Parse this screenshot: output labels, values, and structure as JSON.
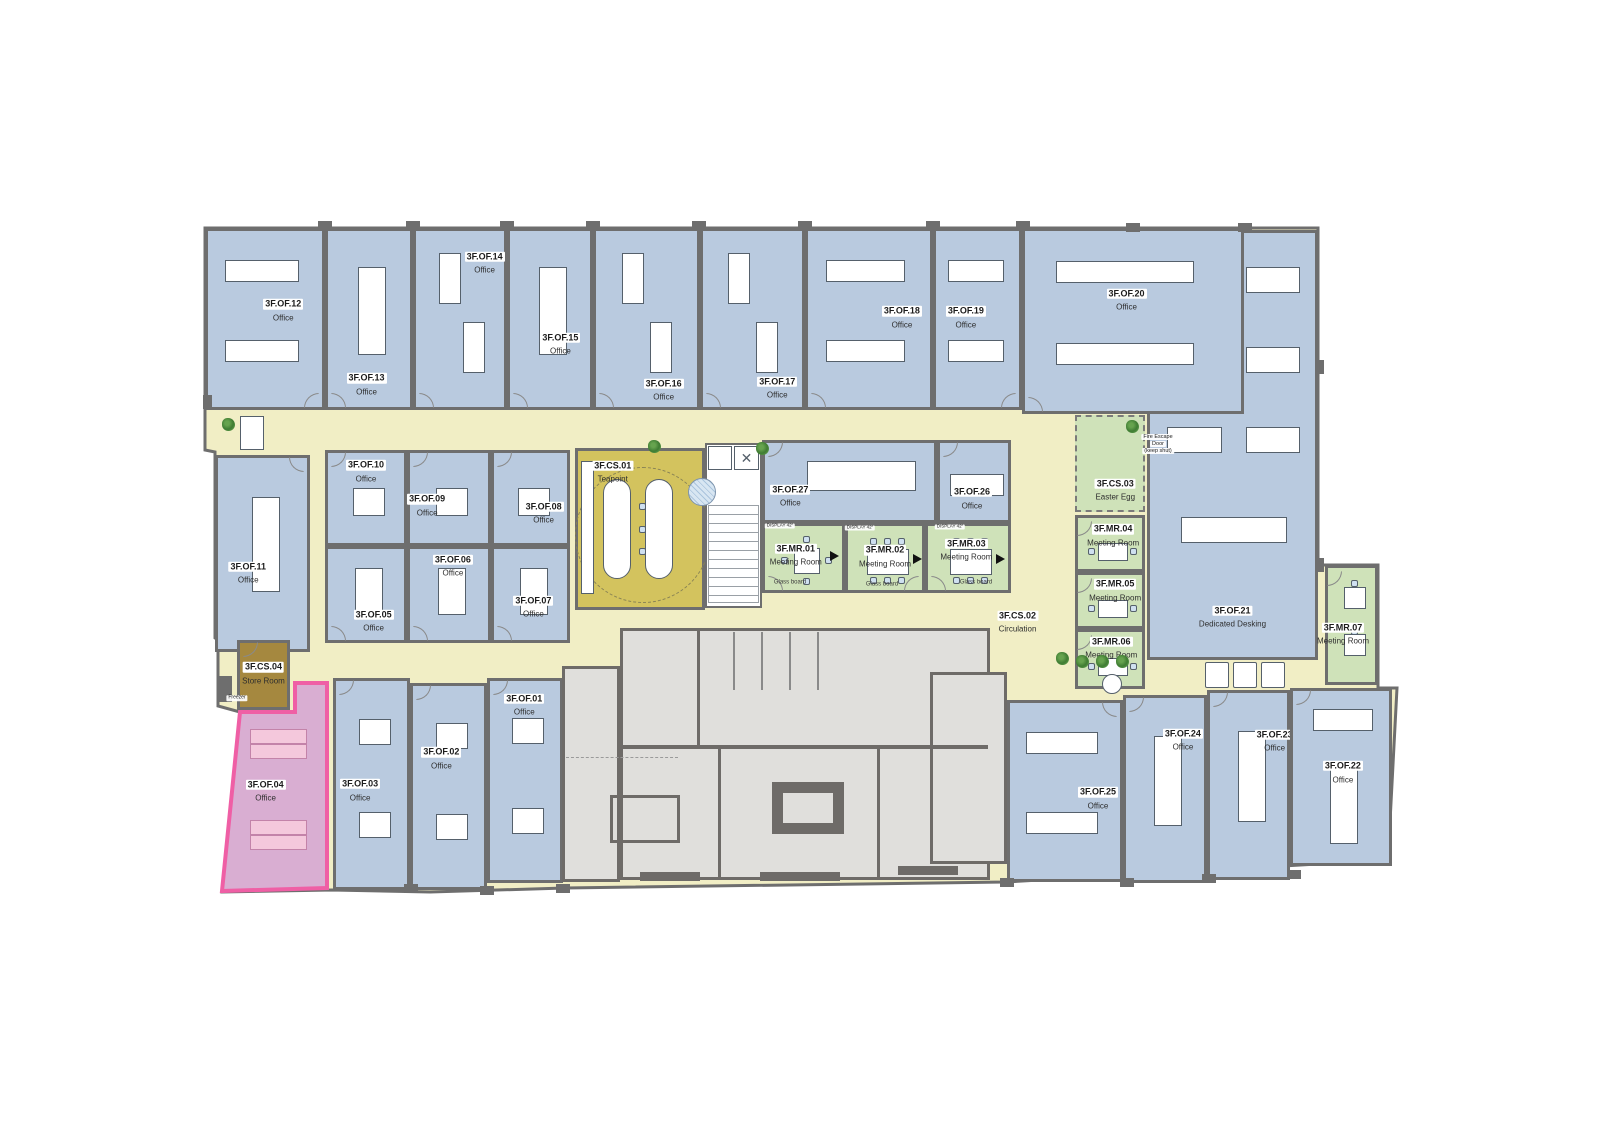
{
  "palette": {
    "office": "#b9cadf",
    "meeting": "#cfe2b9",
    "corridor": "#f1eec5",
    "teapoint": "#d3c35e",
    "store": "#a5883f",
    "special_office": "#d9aed2",
    "special_border": "#ef5fa5",
    "core": "#e0dfdc",
    "wall": "#6e6e6e"
  },
  "rooms": [
    {
      "code": "3F.OF.21",
      "name": "Dedicated Desking",
      "x": 1147,
      "y": 230,
      "w": 171,
      "h": 430,
      "t": "of",
      "lx": 0.5,
      "ly": 0.9,
      "f": "grid",
      "door": null
    },
    {
      "code": "3F.OF.12",
      "name": "Office",
      "x": 205,
      "y": 228,
      "w": 120,
      "h": 182,
      "t": "of",
      "lx": 0.66,
      "ly": 0.44,
      "f": "h2",
      "door": "br"
    },
    {
      "code": "3F.OF.13",
      "name": "Office",
      "x": 325,
      "y": 228,
      "w": 88,
      "h": 182,
      "t": "of",
      "lx": 0.47,
      "ly": 0.86,
      "f": "v1",
      "door": "bl"
    },
    {
      "code": "3F.OF.14",
      "name": "Office",
      "x": 413,
      "y": 228,
      "w": 94,
      "h": 182,
      "t": "of",
      "lx": 0.78,
      "ly": 0.17,
      "f": "v2sm",
      "door": "bl"
    },
    {
      "code": "3F.OF.15",
      "name": "Office",
      "x": 507,
      "y": 228,
      "w": 86,
      "h": 182,
      "t": "of",
      "lx": 0.63,
      "ly": 0.63,
      "f": "v1",
      "door": "bl"
    },
    {
      "code": "3F.OF.16",
      "name": "Office",
      "x": 593,
      "y": 228,
      "w": 107,
      "h": 182,
      "t": "of",
      "lx": 0.67,
      "ly": 0.89,
      "f": "v2sm",
      "door": "bl"
    },
    {
      "code": "3F.OF.17",
      "name": "Office",
      "x": 700,
      "y": 228,
      "w": 105,
      "h": 182,
      "t": "of",
      "lx": 0.75,
      "ly": 0.88,
      "f": "v2sm",
      "door": "bl"
    },
    {
      "code": "3F.OF.18",
      "name": "Office",
      "x": 805,
      "y": 228,
      "w": 128,
      "h": 182,
      "t": "of",
      "lx": 0.77,
      "ly": 0.48,
      "f": "h2",
      "door": "bl"
    },
    {
      "code": "3F.OF.19",
      "name": "Office",
      "x": 933,
      "y": 228,
      "w": 89,
      "h": 182,
      "t": "of",
      "lx": 0.36,
      "ly": 0.48,
      "f": "h2",
      "door": "br"
    },
    {
      "code": "3F.OF.20",
      "name": "Office",
      "x": 1022,
      "y": 228,
      "w": 222,
      "h": 186,
      "t": "of",
      "lx": 0.47,
      "ly": 0.37,
      "f": "h2",
      "door": "bl"
    },
    {
      "code": "3F.OF.11",
      "name": "Office",
      "x": 215,
      "y": 455,
      "w": 95,
      "h": 197,
      "t": "of",
      "lx": 0.34,
      "ly": 0.59,
      "f": "v1",
      "door": "tr"
    },
    {
      "code": "3F.OF.10",
      "name": "Office",
      "x": 325,
      "y": 450,
      "w": 82,
      "h": 96,
      "t": "of",
      "lx": 0.5,
      "ly": 0.18,
      "f": "sq1",
      "door": "tl"
    },
    {
      "code": "3F.OF.09",
      "name": "Office",
      "x": 407,
      "y": 450,
      "w": 84,
      "h": 96,
      "t": "of",
      "lx": 0.22,
      "ly": 0.56,
      "f": "sq1",
      "door": "tl"
    },
    {
      "code": "3F.OF.08",
      "name": "Office",
      "x": 491,
      "y": 450,
      "w": 79,
      "h": 96,
      "t": "of",
      "lx": 0.68,
      "ly": 0.64,
      "f": "sq1",
      "door": "tl"
    },
    {
      "code": "3F.OF.05",
      "name": "Office",
      "x": 325,
      "y": 546,
      "w": 82,
      "h": 97,
      "t": "of",
      "lx": 0.6,
      "ly": 0.77,
      "f": "v1",
      "door": "bl"
    },
    {
      "code": "3F.OF.06",
      "name": "Office",
      "x": 407,
      "y": 546,
      "w": 84,
      "h": 97,
      "t": "of",
      "lx": 0.55,
      "ly": 0.16,
      "f": "v1",
      "door": "bl"
    },
    {
      "code": "3F.OF.07",
      "name": "Office",
      "x": 491,
      "y": 546,
      "w": 79,
      "h": 97,
      "t": "of",
      "lx": 0.54,
      "ly": 0.61,
      "f": "v1",
      "door": "bl"
    },
    {
      "code": "3F.CS.01",
      "name": "Teapoint",
      "x": 575,
      "y": 448,
      "w": 130,
      "h": 162,
      "t": "tea",
      "lx": 0.28,
      "ly": 0.12,
      "f": "tea",
      "door": null
    },
    {
      "code": "3F.OF.27",
      "name": "Office",
      "x": 762,
      "y": 440,
      "w": 175,
      "h": 83,
      "t": "of",
      "lx": 0.15,
      "ly": 0.66,
      "f": "h1big",
      "door": "tl"
    },
    {
      "code": "3F.OF.26",
      "name": "Office",
      "x": 937,
      "y": 440,
      "w": 74,
      "h": 83,
      "t": "of",
      "lx": 0.47,
      "ly": 0.69,
      "f": "h1",
      "door": "tl"
    },
    {
      "code": "3F.MR.01",
      "name": "Meeting Room",
      "x": 762,
      "y": 523,
      "w": 83,
      "h": 70,
      "t": "mr",
      "lx": 0.4,
      "ly": 0.42,
      "f": "mtg4",
      "door": "bl"
    },
    {
      "code": "3F.MR.02",
      "name": "Meeting Room",
      "x": 845,
      "y": 523,
      "w": 80,
      "h": 70,
      "t": "mr",
      "lx": 0.5,
      "ly": 0.44,
      "f": "mtg6",
      "door": "br"
    },
    {
      "code": "3F.MR.03",
      "name": "Meeting Room",
      "x": 925,
      "y": 523,
      "w": 86,
      "h": 70,
      "t": "mr",
      "lx": 0.48,
      "ly": 0.34,
      "f": "mtg6",
      "door": "bl"
    },
    {
      "code": "3F.CS.03",
      "name": "Easter Egg",
      "x": 1075,
      "y": 415,
      "w": 70,
      "h": 97,
      "t": "egg",
      "lx": 0.58,
      "ly": 0.76,
      "f": null,
      "door": null
    },
    {
      "code": "3F.MR.04",
      "name": "Meeting Room",
      "x": 1075,
      "y": 515,
      "w": 70,
      "h": 57,
      "t": "mr",
      "lx": 0.55,
      "ly": 0.3,
      "f": "mtg2",
      "door": "lt"
    },
    {
      "code": "3F.MR.05",
      "name": "Meeting Room",
      "x": 1075,
      "y": 572,
      "w": 70,
      "h": 57,
      "t": "mr",
      "lx": 0.58,
      "ly": 0.26,
      "f": "mtg2",
      "door": "lt"
    },
    {
      "code": "3F.MR.06",
      "name": "Meeting Room",
      "x": 1075,
      "y": 629,
      "w": 70,
      "h": 60,
      "t": "mr",
      "lx": 0.52,
      "ly": 0.26,
      "f": "mtg2",
      "door": "lt"
    },
    {
      "code": "3F.MR.07",
      "name": "Meeting Room",
      "x": 1325,
      "y": 565,
      "w": 53,
      "h": 120,
      "t": "mr",
      "lx": 0.32,
      "ly": 0.56,
      "f": "mtg2v",
      "door": "lt"
    },
    {
      "code": "3F.CS.04",
      "name": "Store Room",
      "x": 237,
      "y": 640,
      "w": 53,
      "h": 70,
      "t": "store",
      "lx": 0.5,
      "ly": 0.44,
      "f": null,
      "door": "tl"
    },
    {
      "code": "3F.OF.04",
      "name": "Office",
      "x": 228,
      "y": 683,
      "w": 99,
      "h": 208,
      "t": "pink",
      "lx": 0.38,
      "ly": 0.51,
      "f": "pink",
      "door": null
    },
    {
      "code": "3F.OF.03",
      "name": "Office",
      "x": 333,
      "y": 678,
      "w": 77,
      "h": 212,
      "t": "of",
      "lx": 0.34,
      "ly": 0.52,
      "f": "sq2",
      "door": "tl"
    },
    {
      "code": "3F.OF.02",
      "name": "Office",
      "x": 410,
      "y": 683,
      "w": 77,
      "h": 207,
      "t": "of",
      "lx": 0.4,
      "ly": 0.35,
      "f": "sq2",
      "door": "tl"
    },
    {
      "code": "3F.OF.01",
      "name": "Office",
      "x": 487,
      "y": 678,
      "w": 76,
      "h": 205,
      "t": "of",
      "lx": 0.49,
      "ly": 0.11,
      "f": "sq2",
      "door": "tl"
    },
    {
      "code": "3F.OF.25",
      "name": "Office",
      "x": 1007,
      "y": 700,
      "w": 116,
      "h": 182,
      "t": "of",
      "lx": 0.8,
      "ly": 0.53,
      "f": "h2",
      "door": "tr"
    },
    {
      "code": "3F.OF.24",
      "name": "Office",
      "x": 1123,
      "y": 695,
      "w": 84,
      "h": 188,
      "t": "of",
      "lx": 0.73,
      "ly": 0.22,
      "f": "v1",
      "door": "tl"
    },
    {
      "code": "3F.OF.23",
      "name": "Office",
      "x": 1207,
      "y": 690,
      "w": 83,
      "h": 190,
      "t": "of",
      "lx": 0.84,
      "ly": 0.25,
      "f": "v1",
      "door": "tl"
    },
    {
      "code": "3F.OF.22",
      "name": "Office",
      "x": 1290,
      "y": 688,
      "w": 102,
      "h": 178,
      "t": "of",
      "lx": 0.52,
      "ly": 0.46,
      "f": "v1h1",
      "door": "tl"
    },
    {
      "code": "3F.CS.02",
      "name": "Circulation",
      "x": 975,
      "y": 603,
      "w": 85,
      "h": 34,
      "t": "lbl",
      "lx": 0.5,
      "ly": 0.5,
      "f": null,
      "door": null
    }
  ],
  "annotations": [
    {
      "text": "Fire Escape",
      "x": 1158,
      "y": 437,
      "s": 5.5,
      "bg": true
    },
    {
      "text": "Door",
      "x": 1158,
      "y": 444,
      "s": 5.5,
      "bg": true
    },
    {
      "text": "(keep shut)",
      "x": 1158,
      "y": 451,
      "s": 5.5,
      "bg": true
    },
    {
      "text": "Glass board",
      "x": 790,
      "y": 583,
      "s": 6,
      "bg": false
    },
    {
      "text": "Glass board",
      "x": 882,
      "y": 585,
      "s": 6,
      "bg": false
    },
    {
      "text": "Glass board",
      "x": 976,
      "y": 583,
      "s": 6,
      "bg": false
    },
    {
      "text": "DISPLAY 42\"",
      "x": 780,
      "y": 526,
      "s": 4.5,
      "bg": true
    },
    {
      "text": "DISPLAY 42\"",
      "x": 860,
      "y": 528,
      "s": 4.5,
      "bg": true
    },
    {
      "text": "DISPLAY 42\"",
      "x": 950,
      "y": 527,
      "s": 4.5,
      "bg": true
    },
    {
      "text": "Freezer",
      "x": 237,
      "y": 698,
      "s": 5,
      "bg": true
    }
  ]
}
